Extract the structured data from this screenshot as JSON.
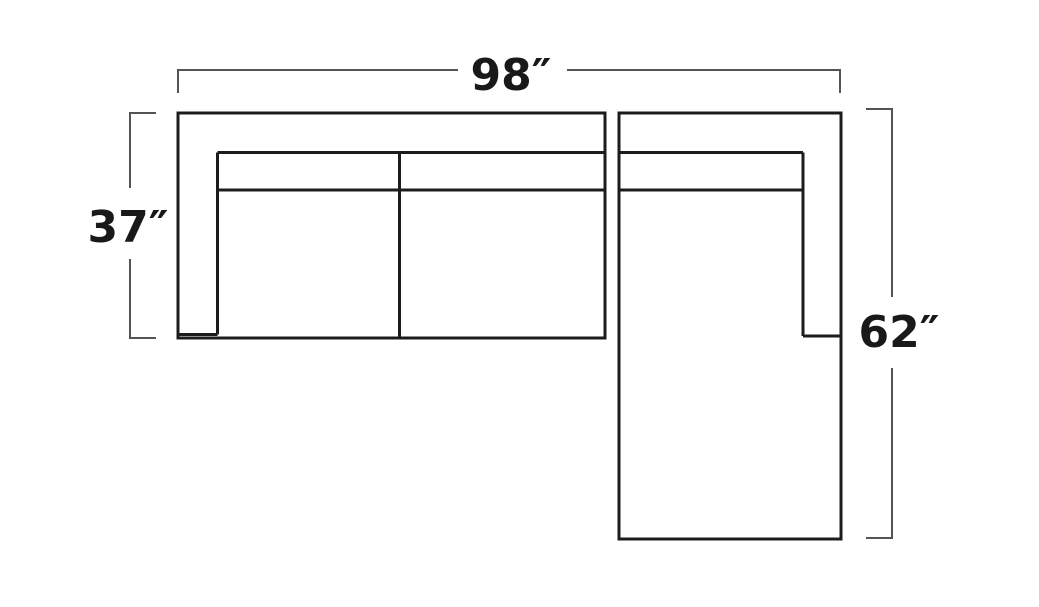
{
  "canvas": {
    "width_px": 1039,
    "height_px": 607,
    "background": "#ffffff"
  },
  "diagram": {
    "kind": "sectional-sofa-dimension-diagram-top-view",
    "pieces": [
      {
        "name": "sofa-section-left-arm",
        "seat_sections": 2
      },
      {
        "name": "chaise-section-right-arm",
        "seat_sections": 1
      }
    ],
    "measurements": {
      "overall_width": {
        "label": "98″",
        "value": 98,
        "unit": "inches",
        "position": "top"
      },
      "sofa_depth": {
        "label": "37″",
        "value": 37,
        "unit": "inches",
        "position": "left"
      },
      "chaise_length": {
        "label": "62″",
        "value": 62,
        "unit": "inches",
        "position": "right"
      }
    },
    "colors": {
      "outline": "#1c1c1c",
      "dimension_line": "#545454",
      "label_text": "#191919",
      "background": "#ffffff"
    }
  }
}
